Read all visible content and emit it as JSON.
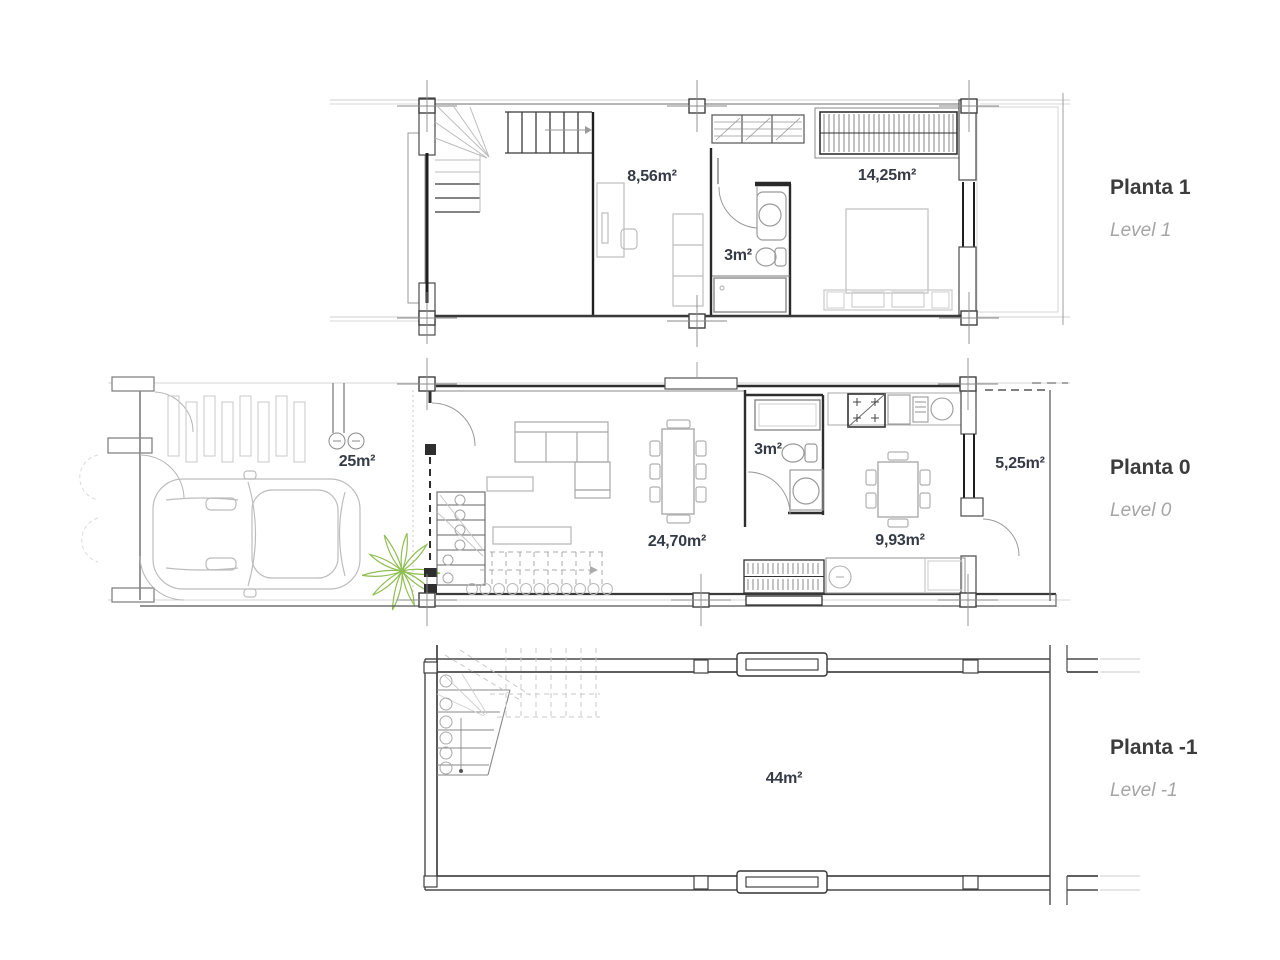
{
  "sheet": {
    "type": "architectural-floor-plans",
    "background": "#ffffff"
  },
  "colors": {
    "wall_dark": "#2e2e2e",
    "wall_medium": "#6b6b6b",
    "construction_light": "#c9c9c9",
    "furniture_gray": "#b5b5b5",
    "plant_green": "#8fbe52",
    "area_label": "#353b46",
    "title": "#3c3c3c",
    "subtitle": "#a5a5a5"
  },
  "levels": [
    {
      "id": "planta-1",
      "title": "Planta 1",
      "subtitle": "Level 1",
      "areas": [
        {
          "name": "studio-room",
          "label": "8,56m²"
        },
        {
          "name": "bathroom",
          "label": "3m²"
        },
        {
          "name": "bedroom",
          "label": "14,25m²"
        }
      ]
    },
    {
      "id": "planta-0",
      "title": "Planta 0",
      "subtitle": "Level 0",
      "areas": [
        {
          "name": "garage-patio",
          "label": "25m²"
        },
        {
          "name": "living-dining",
          "label": "24,70m²"
        },
        {
          "name": "bathroom",
          "label": "3m²"
        },
        {
          "name": "kitchen",
          "label": "9,93m²"
        },
        {
          "name": "terrace",
          "label": "5,25m²"
        }
      ]
    },
    {
      "id": "planta-minus-1",
      "title": "Planta -1",
      "subtitle": "Level -1",
      "areas": [
        {
          "name": "basement",
          "label": "44m²"
        }
      ]
    }
  ]
}
